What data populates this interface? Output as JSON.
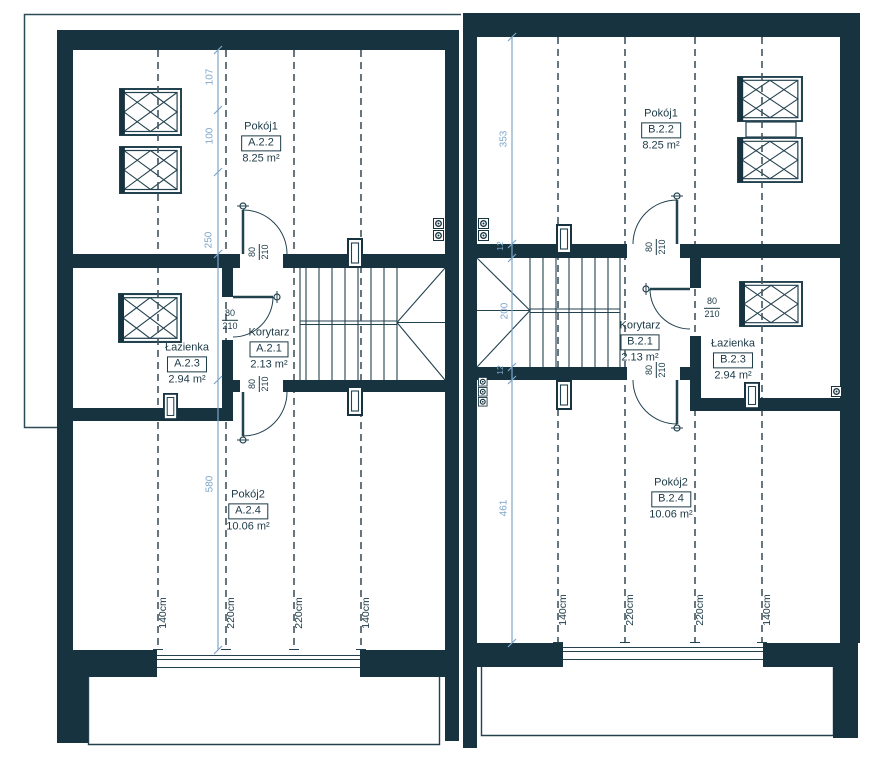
{
  "colors": {
    "wall": "#17333f",
    "line": "#23424f",
    "dimension_blue": "#7ea6c9",
    "dashed": "#42555f",
    "background": "#ffffff"
  },
  "units": [
    {
      "id": "A",
      "rooms": [
        {
          "name": "Pokój1",
          "code": "A.2.2",
          "area": "8.25 m²"
        },
        {
          "name": "Korytarz",
          "code": "A.2.1",
          "area": "2.13 m²"
        },
        {
          "name": "Łazienka",
          "code": "A.2.3",
          "area": "2.94 m²"
        },
        {
          "name": "Pokój2",
          "code": "A.2.4",
          "area": "10.06 m²"
        }
      ],
      "wall_dims": [
        "107",
        "100",
        "250",
        "580"
      ],
      "door_dim": {
        "width": "80",
        "height": "210"
      },
      "height_lines": [
        "140cm",
        "220cm",
        "220cm",
        "140cm"
      ]
    },
    {
      "id": "B",
      "rooms": [
        {
          "name": "Pokój1",
          "code": "B.2.2",
          "area": "8.25 m²"
        },
        {
          "name": "Korytarz",
          "code": "B.2.1",
          "area": "2.13 m²"
        },
        {
          "name": "Łazienka",
          "code": "B.2.3",
          "area": "2.94 m²"
        },
        {
          "name": "Pokój2",
          "code": "B.2.4",
          "area": "10.06 m²"
        }
      ],
      "wall_dims": [
        "353",
        "12",
        "200",
        "12",
        "461"
      ],
      "door_dim": {
        "width": "80",
        "height": "210"
      },
      "height_lines": [
        "140cm",
        "220cm",
        "220cm",
        "140cm"
      ]
    }
  ]
}
